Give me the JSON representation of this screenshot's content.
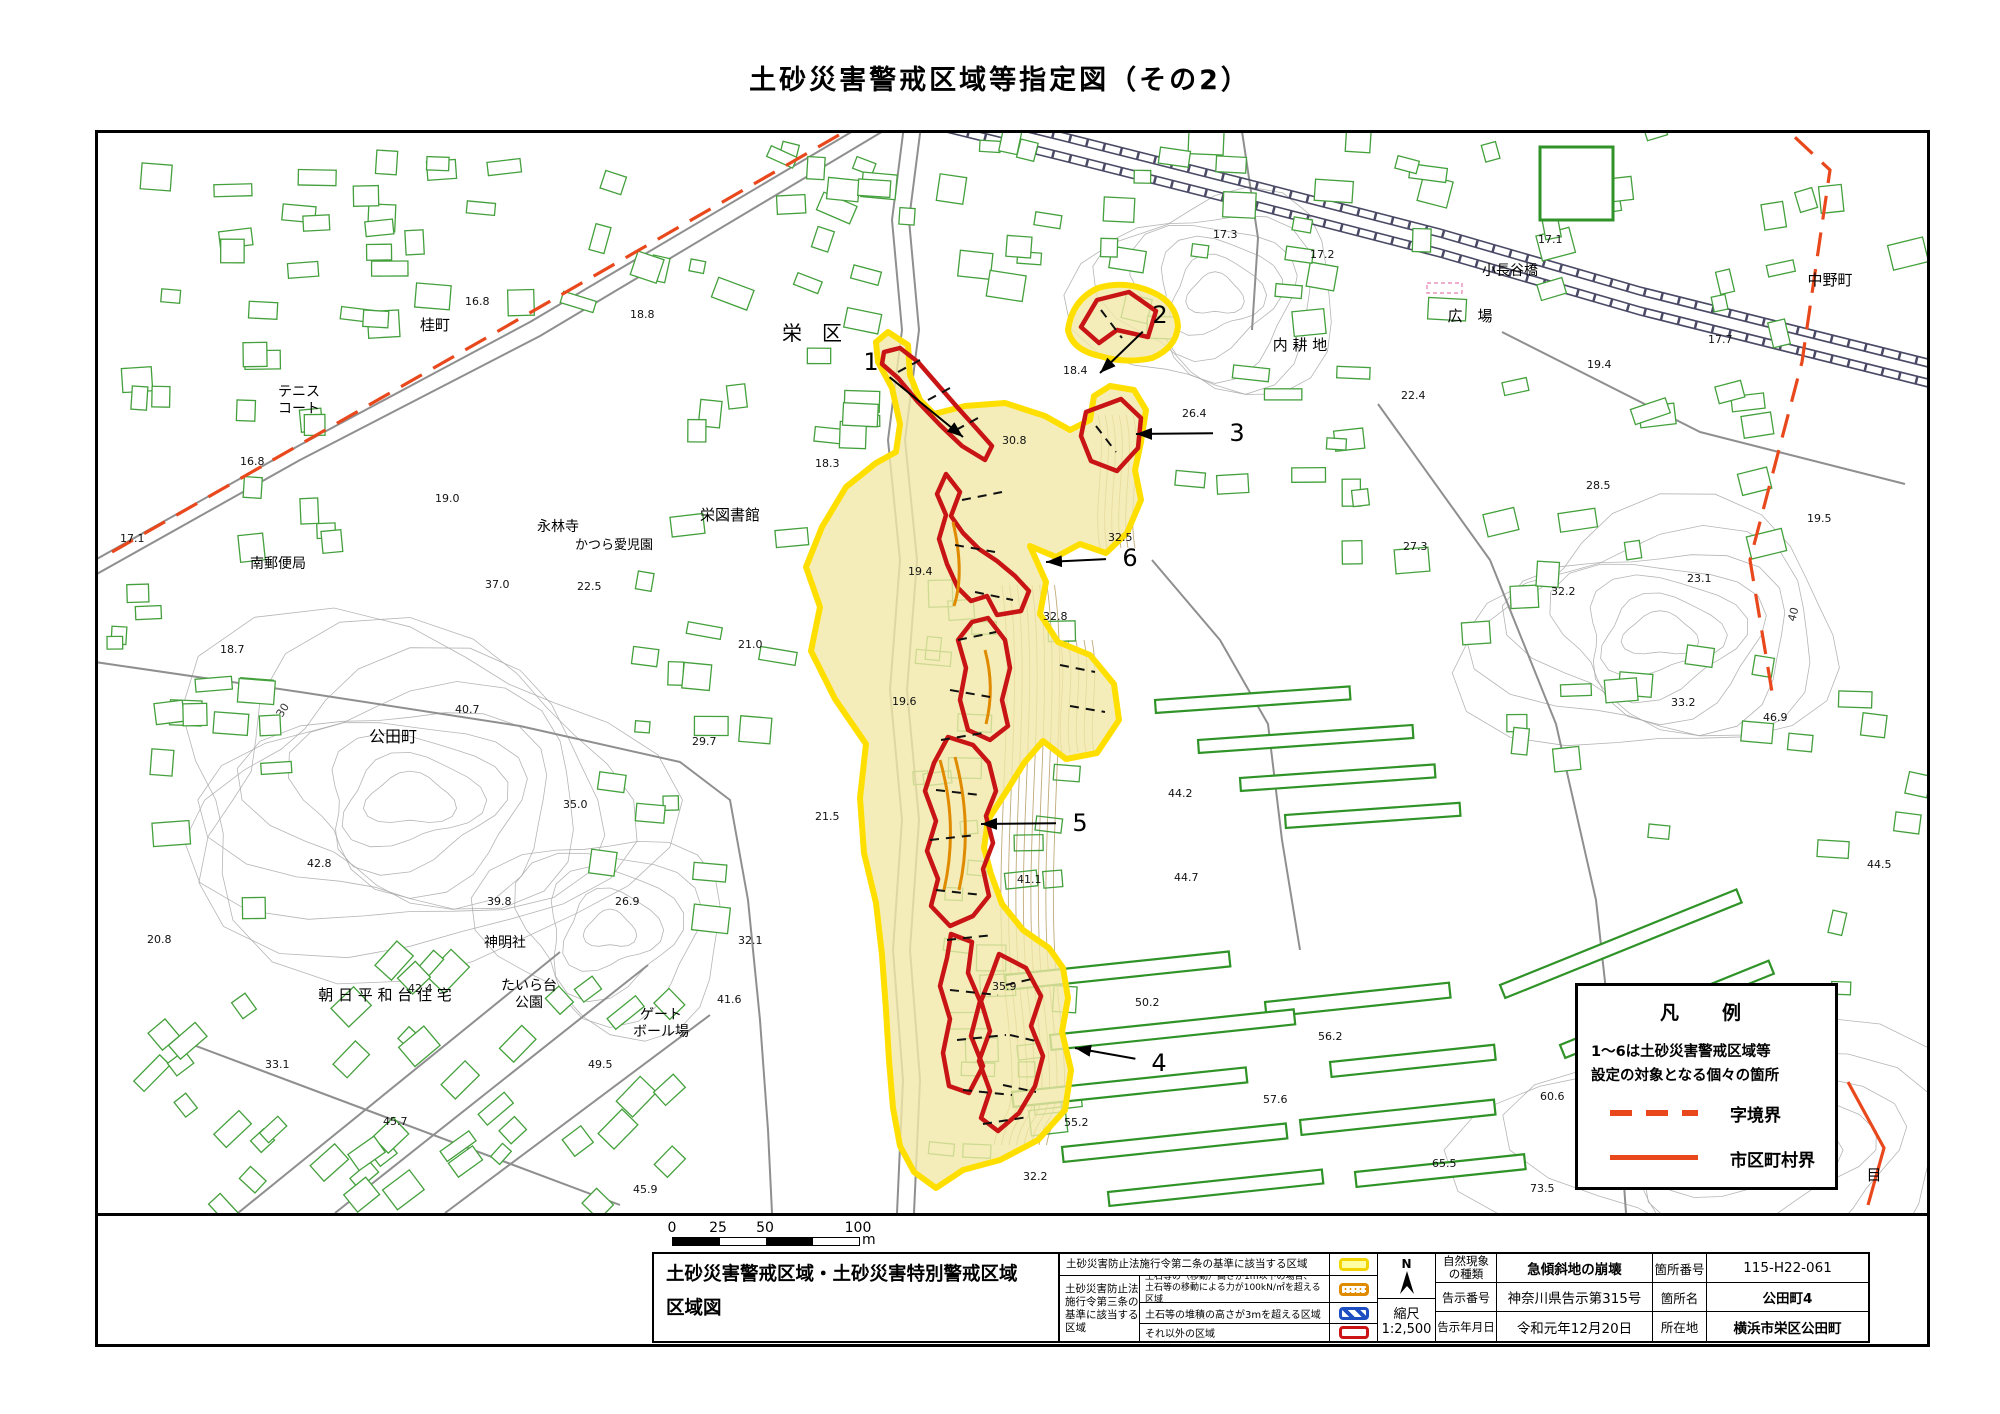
{
  "title": "土砂災害警戒区域等指定図（その2）",
  "colors": {
    "zone_yellow_stroke": "#ffdf00",
    "zone_yellow_fill": "#f1e9a8",
    "special_zone_red": "#c81414",
    "orange_line": "#e08a00",
    "boundary_red": "#e8481c",
    "building_green": "#44a03c",
    "danchi_green": "#2f9328",
    "railway": "#4a4a66",
    "road_gray": "#8f8f8f",
    "contour_gray": "#a8a8a8",
    "contour_brown": "#c0aa78"
  },
  "map": {
    "place_labels": [
      {
        "t": "桂町",
        "x": 435,
        "y": 330,
        "s": 15
      },
      {
        "t": "テニス",
        "x": 299,
        "y": 396,
        "s": 14
      },
      {
        "t": "コート",
        "x": 299,
        "y": 413,
        "s": 14
      },
      {
        "t": "南郵便局",
        "x": 278,
        "y": 568,
        "s": 14
      },
      {
        "t": "永林寺",
        "x": 558,
        "y": 531,
        "s": 14
      },
      {
        "t": "かつら愛児園",
        "x": 614,
        "y": 549,
        "s": 13
      },
      {
        "t": "栄図書館",
        "x": 730,
        "y": 520,
        "s": 15
      },
      {
        "t": "栄　区",
        "x": 812,
        "y": 340,
        "s": 20
      },
      {
        "t": "公田町",
        "x": 393,
        "y": 742,
        "s": 16
      },
      {
        "t": "神明社",
        "x": 505,
        "y": 947,
        "s": 14
      },
      {
        "t": "朝 日 平 和 台 住 宅",
        "x": 385,
        "y": 1000,
        "s": 15
      },
      {
        "t": "たいら台",
        "x": 529,
        "y": 990,
        "s": 14
      },
      {
        "t": "公園",
        "x": 529,
        "y": 1007,
        "s": 14
      },
      {
        "t": "ゲート",
        "x": 661,
        "y": 1019,
        "s": 14
      },
      {
        "t": "ボール場",
        "x": 661,
        "y": 1036,
        "s": 14
      },
      {
        "t": "内 耕 地",
        "x": 1300,
        "y": 350,
        "s": 15
      },
      {
        "t": "広　場",
        "x": 1470,
        "y": 321,
        "s": 15
      },
      {
        "t": "小長谷橋",
        "x": 1510,
        "y": 275,
        "s": 14
      },
      {
        "t": "中野町",
        "x": 1830,
        "y": 285,
        "s": 15
      },
      {
        "t": "目",
        "x": 1874,
        "y": 1180,
        "s": 15
      }
    ],
    "spot_heights": [
      {
        "t": "17.3",
        "x": 1213,
        "y": 238
      },
      {
        "t": "17.2",
        "x": 1310,
        "y": 258
      },
      {
        "t": "17.1",
        "x": 1538,
        "y": 243
      },
      {
        "t": "17.7",
        "x": 1708,
        "y": 343
      },
      {
        "t": "19.4",
        "x": 1587,
        "y": 368
      },
      {
        "t": "16.8",
        "x": 465,
        "y": 305
      },
      {
        "t": "18.8",
        "x": 630,
        "y": 318
      },
      {
        "t": "16.8",
        "x": 240,
        "y": 465
      },
      {
        "t": "19.0",
        "x": 435,
        "y": 502
      },
      {
        "t": "17.1",
        "x": 120,
        "y": 542
      },
      {
        "t": "18.7",
        "x": 220,
        "y": 653
      },
      {
        "t": "22.5",
        "x": 577,
        "y": 590
      },
      {
        "t": "37.0",
        "x": 485,
        "y": 588
      },
      {
        "t": "18.3",
        "x": 815,
        "y": 467
      },
      {
        "t": "18.4",
        "x": 1063,
        "y": 374
      },
      {
        "t": "26.4",
        "x": 1182,
        "y": 417
      },
      {
        "t": "30.8",
        "x": 1002,
        "y": 444
      },
      {
        "t": "32.5",
        "x": 1108,
        "y": 541
      },
      {
        "t": "19.4",
        "x": 908,
        "y": 575
      },
      {
        "t": "21.0",
        "x": 738,
        "y": 648
      },
      {
        "t": "19.6",
        "x": 892,
        "y": 705
      },
      {
        "t": "29.7",
        "x": 692,
        "y": 745
      },
      {
        "t": "32.8",
        "x": 1043,
        "y": 620
      },
      {
        "t": "21.5",
        "x": 815,
        "y": 820
      },
      {
        "t": "32.1",
        "x": 738,
        "y": 944
      },
      {
        "t": "41.6",
        "x": 717,
        "y": 1003
      },
      {
        "t": "41.1",
        "x": 1017,
        "y": 883
      },
      {
        "t": "22.4",
        "x": 1401,
        "y": 399
      },
      {
        "t": "28.5",
        "x": 1586,
        "y": 489
      },
      {
        "t": "19.5",
        "x": 1807,
        "y": 522
      },
      {
        "t": "23.1",
        "x": 1687,
        "y": 582
      },
      {
        "t": "27.3",
        "x": 1403,
        "y": 550
      },
      {
        "t": "32.2",
        "x": 1551,
        "y": 595
      },
      {
        "t": "33.2",
        "x": 1671,
        "y": 706
      },
      {
        "t": "46.9",
        "x": 1763,
        "y": 721
      },
      {
        "t": "44.2",
        "x": 1168,
        "y": 797
      },
      {
        "t": "44.5",
        "x": 1867,
        "y": 868
      },
      {
        "t": "44.7",
        "x": 1174,
        "y": 881
      },
      {
        "t": "35.9",
        "x": 992,
        "y": 990
      },
      {
        "t": "50.2",
        "x": 1135,
        "y": 1006
      },
      {
        "t": "56.2",
        "x": 1318,
        "y": 1040
      },
      {
        "t": "57.6",
        "x": 1263,
        "y": 1103
      },
      {
        "t": "55.2",
        "x": 1064,
        "y": 1126
      },
      {
        "t": "32.2",
        "x": 1023,
        "y": 1180
      },
      {
        "t": "35.0",
        "x": 563,
        "y": 808
      },
      {
        "t": "39.8",
        "x": 487,
        "y": 905
      },
      {
        "t": "26.9",
        "x": 615,
        "y": 905
      },
      {
        "t": "40.7",
        "x": 455,
        "y": 713
      },
      {
        "t": "42.8",
        "x": 307,
        "y": 867
      },
      {
        "t": "20.8",
        "x": 147,
        "y": 943
      },
      {
        "t": "42.4",
        "x": 408,
        "y": 992
      },
      {
        "t": "33.1",
        "x": 265,
        "y": 1068
      },
      {
        "t": "49.5",
        "x": 588,
        "y": 1068
      },
      {
        "t": "45.7",
        "x": 383,
        "y": 1125
      },
      {
        "t": "45.9",
        "x": 633,
        "y": 1193
      },
      {
        "t": "60.6",
        "x": 1540,
        "y": 1100
      },
      {
        "t": "65.5",
        "x": 1432,
        "y": 1167
      },
      {
        "t": "73.5",
        "x": 1530,
        "y": 1192
      }
    ],
    "contour_labels": [
      {
        "t": "30",
        "x": 282,
        "y": 718,
        "r": -58
      },
      {
        "t": "40",
        "x": 1795,
        "y": 622,
        "r": -75
      }
    ],
    "zone_markers": [
      {
        "n": "1",
        "lx": 871,
        "ly": 362,
        "tx": 963,
        "ty": 437
      },
      {
        "n": "2",
        "lx": 1160,
        "ly": 315,
        "tx": 1100,
        "ty": 373
      },
      {
        "n": "3",
        "lx": 1237,
        "ly": 433,
        "tx": 1136,
        "ty": 434
      },
      {
        "n": "6",
        "lx": 1130,
        "ly": 558,
        "tx": 1046,
        "ty": 562
      },
      {
        "n": "5",
        "lx": 1080,
        "ly": 823,
        "tx": 981,
        "ty": 824
      },
      {
        "n": "4",
        "lx": 1159,
        "ly": 1063,
        "tx": 1075,
        "ty": 1048
      }
    ],
    "legend_box": {
      "title": "凡　例",
      "line1": "1～6は土砂災害警戒区域等",
      "line2": "設定の対象となる個々の箇所",
      "dashed_label": "字境界",
      "solid_label": "市区町村界"
    }
  },
  "scale_bar": {
    "labels": [
      "0",
      "25",
      "50",
      "100"
    ],
    "unit": "m"
  },
  "bottom": {
    "left_title": [
      "土砂災害警戒区域・土砂災害特別警戒区域",
      "区域図"
    ],
    "hazard_legend": {
      "row1": "土砂災害防止法施行令第二条の基準に該当する区域",
      "group_label": [
        "土砂災害防止法",
        "施行令第三条の",
        "基準に該当する",
        "区域"
      ],
      "row2a": "土石等の（移動）高さが1m以下の場合、",
      "row2b": "土石等の移動による力が100kN/㎡を超える区域",
      "row3": "土石等の堆積の高さが3mを超える区域",
      "row4": "それ以外の区域"
    },
    "compass": {
      "n": "N",
      "scale_label": "縮尺",
      "scale_value": "1:2,500"
    },
    "info": {
      "r1c1": [
        "自然現象",
        "の種類"
      ],
      "r1c2": "急傾斜地の崩壊",
      "r1c3": "箇所番号",
      "r1c4": "115-H22-061",
      "r2c1": "告示番号",
      "r2c2": "神奈川県告示第315号",
      "r2c3": "箇所名",
      "r2c4": "公田町4",
      "r3c1": "告示年月日",
      "r3c2": "令和元年12月20日",
      "r3c3": "所在地",
      "r3c4": "横浜市栄区公田町"
    }
  }
}
